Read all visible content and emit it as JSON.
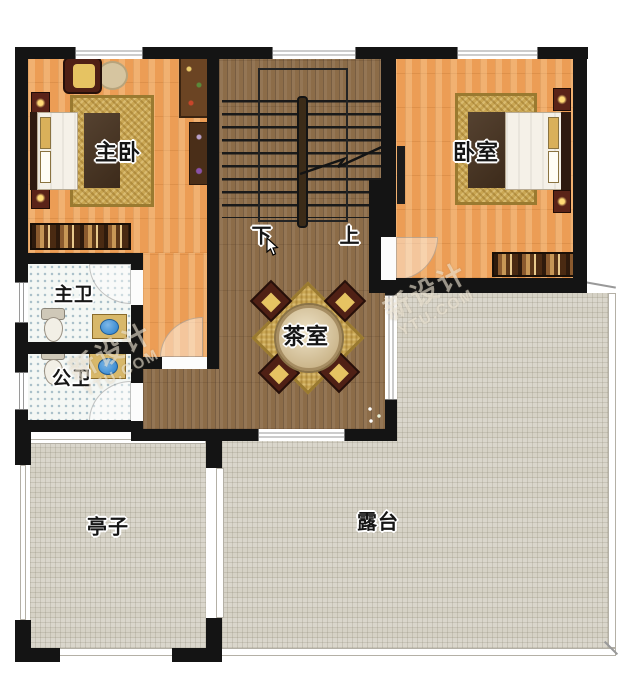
{
  "floorplan": {
    "rooms": {
      "master_bedroom": {
        "label": "主卧"
      },
      "bedroom": {
        "label": "卧室"
      },
      "master_bath": {
        "label": "主卫"
      },
      "public_bath": {
        "label": "公卫"
      },
      "tea_room": {
        "label": "茶室"
      },
      "pavilion": {
        "label": "亭子"
      },
      "terrace": {
        "label": "露台"
      }
    },
    "stairs": {
      "down_label": "下",
      "up_label": "上"
    },
    "watermark": {
      "line1": "新设计",
      "line2": "YTU.COM"
    },
    "colors": {
      "wall": "#141414",
      "bedroom_floor": "#ec9d55",
      "hall_floor": "#8c6c48",
      "tile_floor": "#d6d2c6",
      "bath_floor": "#f4f7f4",
      "rug_gold": "#c9a653",
      "furniture_maroon": "#4f2015",
      "sink_blue": "#3f8fd4",
      "plant_green": "#4a7a34"
    }
  }
}
